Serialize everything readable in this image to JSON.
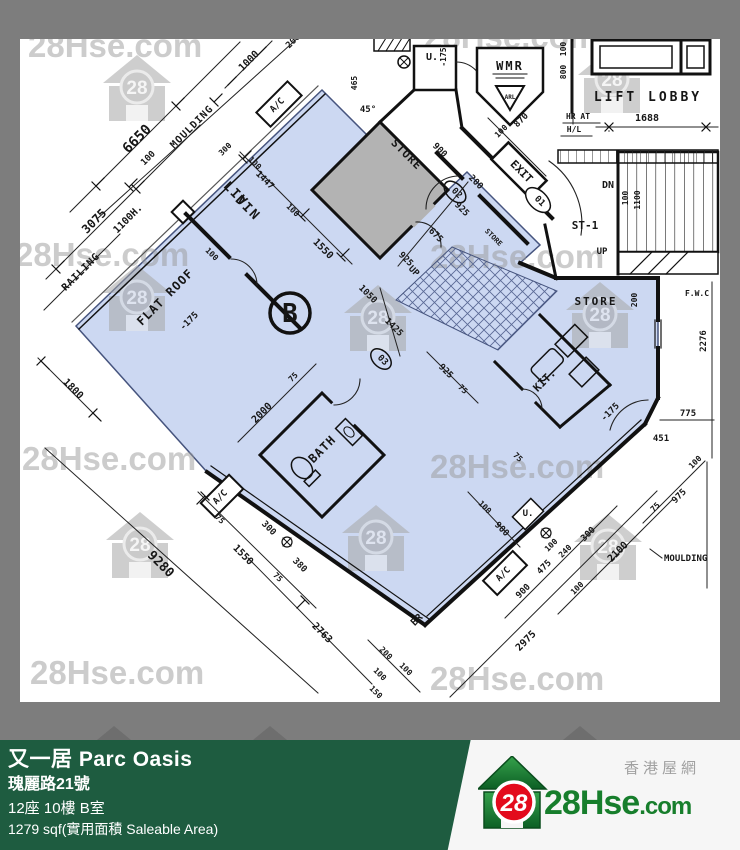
{
  "watermark": {
    "text": "28Hse.com",
    "badge": "28",
    "text_positions": [
      [
        28,
        57
      ],
      [
        424,
        48
      ],
      [
        15,
        266
      ],
      [
        430,
        268
      ],
      [
        22,
        470
      ],
      [
        430,
        478
      ],
      [
        30,
        684
      ],
      [
        430,
        690
      ]
    ],
    "house_positions": [
      [
        102,
        55
      ],
      [
        577,
        47
      ],
      [
        102,
        265
      ],
      [
        343,
        285
      ],
      [
        565,
        282
      ],
      [
        105,
        512
      ],
      [
        341,
        505
      ],
      [
        573,
        514
      ]
    ]
  },
  "floor_plan": {
    "unit_label": "B",
    "highlight_color": "#ccd8f2",
    "labels": [
      {
        "t": "6650",
        "x": 140,
        "y": 142,
        "r": -45,
        "s": 14
      },
      {
        "t": "3075",
        "x": 97,
        "y": 224,
        "r": -45,
        "s": 12
      },
      {
        "t": "100",
        "x": 150,
        "y": 160,
        "r": -45,
        "s": 9
      },
      {
        "t": "MOULDING",
        "x": 194,
        "y": 129,
        "r": -45,
        "s": 10,
        "ls": 1
      },
      {
        "t": "RAILING",
        "x": 83,
        "y": 274,
        "r": -45,
        "s": 10,
        "ls": 1
      },
      {
        "t": "1100H.",
        "x": 130,
        "y": 221,
        "r": -45,
        "s": 10
      },
      {
        "t": "1000",
        "x": 251,
        "y": 63,
        "r": -45,
        "s": 10
      },
      {
        "t": "200",
        "x": 295,
        "y": 43,
        "r": -45,
        "s": 9
      },
      {
        "t": "300",
        "x": 227,
        "y": 151,
        "r": -45,
        "s": 8
      },
      {
        "t": "A/C",
        "x": 279,
        "y": 107,
        "r": -45,
        "s": 9
      },
      {
        "t": "465",
        "x": 357,
        "y": 83,
        "r": -90,
        "s": 8
      },
      {
        "t": "45°",
        "x": 368,
        "y": 112,
        "r": 0,
        "s": 9
      },
      {
        "t": "-175",
        "x": 446,
        "y": 57,
        "r": -90,
        "s": 8
      },
      {
        "t": "U.",
        "x": 432,
        "y": 60,
        "r": 0,
        "s": 10
      },
      {
        "t": "WMR",
        "x": 510,
        "y": 70,
        "r": 0,
        "s": 12,
        "ls": 2
      },
      {
        "t": "ARL",
        "x": 510,
        "y": 99,
        "r": 0,
        "s": 6
      },
      {
        "t": "100",
        "x": 566,
        "y": 49,
        "r": -90,
        "s": 8
      },
      {
        "t": "800",
        "x": 566,
        "y": 72,
        "r": -90,
        "s": 8
      },
      {
        "t": "LIFT LOBBY",
        "x": 648,
        "y": 101,
        "r": 0,
        "s": 13,
        "ls": 3
      },
      {
        "t": "HR AT",
        "x": 578,
        "y": 119,
        "r": 0,
        "s": 8
      },
      {
        "t": "H/L",
        "x": 574,
        "y": 132,
        "r": 0,
        "s": 8
      },
      {
        "t": "1688",
        "x": 647,
        "y": 121,
        "r": 0,
        "s": 10
      },
      {
        "t": "DN",
        "x": 608,
        "y": 188,
        "r": 0,
        "s": 10
      },
      {
        "t": "ST-1",
        "x": 585,
        "y": 229,
        "r": 0,
        "s": 11
      },
      {
        "t": "UP",
        "x": 602,
        "y": 254,
        "r": 0,
        "s": 9
      },
      {
        "t": "100",
        "x": 628,
        "y": 198,
        "r": -90,
        "s": 8
      },
      {
        "t": "1100",
        "x": 640,
        "y": 200,
        "r": -90,
        "s": 8
      },
      {
        "t": "STORE",
        "x": 404,
        "y": 157,
        "r": 45,
        "s": 11,
        "ls": 1
      },
      {
        "t": "900",
        "x": 438,
        "y": 152,
        "r": 45,
        "s": 9
      },
      {
        "t": "100",
        "x": 503,
        "y": 133,
        "r": -45,
        "s": 8
      },
      {
        "t": "870",
        "x": 523,
        "y": 122,
        "r": -45,
        "s": 9
      },
      {
        "t": "EXIT",
        "x": 519,
        "y": 174,
        "r": 45,
        "s": 11
      },
      {
        "t": "01",
        "x": 538,
        "y": 203,
        "r": 45,
        "s": 9
      },
      {
        "t": "02",
        "x": 455,
        "y": 195,
        "r": 45,
        "s": 9
      },
      {
        "t": "200",
        "x": 474,
        "y": 184,
        "r": 45,
        "s": 9
      },
      {
        "t": "925",
        "x": 460,
        "y": 211,
        "r": 45,
        "s": 9
      },
      {
        "t": "675",
        "x": 434,
        "y": 237,
        "r": 45,
        "s": 9
      },
      {
        "t": "STORE",
        "x": 492,
        "y": 239,
        "r": 45,
        "s": 7
      },
      {
        "t": "925",
        "x": 404,
        "y": 261,
        "r": 45,
        "s": 9
      },
      {
        "t": "UP",
        "x": 412,
        "y": 273,
        "r": 45,
        "s": 9
      },
      {
        "t": "1050",
        "x": 366,
        "y": 296,
        "r": 45,
        "s": 9
      },
      {
        "t": "1425",
        "x": 392,
        "y": 329,
        "r": 45,
        "s": 9
      },
      {
        "t": "03",
        "x": 381,
        "y": 362,
        "r": 45,
        "s": 9
      },
      {
        "t": "925",
        "x": 444,
        "y": 373,
        "r": 45,
        "s": 9
      },
      {
        "t": "75",
        "x": 461,
        "y": 391,
        "r": 45,
        "s": 8
      },
      {
        "t": "100",
        "x": 253,
        "y": 165,
        "r": 45,
        "s": 8
      },
      {
        "t": "1447",
        "x": 263,
        "y": 182,
        "r": 45,
        "s": 9
      },
      {
        "t": "100",
        "x": 291,
        "y": 212,
        "r": 45,
        "s": 8
      },
      {
        "t": "1550",
        "x": 321,
        "y": 251,
        "r": 45,
        "s": 10
      },
      {
        "t": "LIV",
        "x": 233,
        "y": 197,
        "r": 45,
        "s": 13,
        "ls": 2
      },
      {
        "t": "DIN",
        "x": 245,
        "y": 211,
        "r": 45,
        "s": 13,
        "ls": 2
      },
      {
        "t": "FLAT ROOF",
        "x": 168,
        "y": 300,
        "r": -45,
        "s": 12,
        "ls": 1
      },
      {
        "t": "100",
        "x": 210,
        "y": 256,
        "r": 45,
        "s": 8
      },
      {
        "t": "-175",
        "x": 191,
        "y": 323,
        "r": -45,
        "s": 9
      },
      {
        "t": "2000",
        "x": 264,
        "y": 415,
        "r": -45,
        "s": 10
      },
      {
        "t": "75",
        "x": 295,
        "y": 379,
        "r": -45,
        "s": 8
      },
      {
        "t": "B",
        "x": 290,
        "y": 322,
        "r": 0,
        "s": 26,
        "b": 1
      },
      {
        "t": "BATH",
        "x": 325,
        "y": 452,
        "r": -45,
        "s": 12,
        "ls": 1
      },
      {
        "t": "1800",
        "x": 71,
        "y": 391,
        "r": 45,
        "s": 10
      },
      {
        "t": "9280",
        "x": 158,
        "y": 567,
        "r": 45,
        "s": 13
      },
      {
        "t": "75",
        "x": 218,
        "y": 521,
        "r": 45,
        "s": 8
      },
      {
        "t": "1550",
        "x": 241,
        "y": 557,
        "r": 45,
        "s": 10
      },
      {
        "t": "300",
        "x": 267,
        "y": 530,
        "r": 45,
        "s": 9
      },
      {
        "t": "380",
        "x": 298,
        "y": 567,
        "r": 45,
        "s": 9
      },
      {
        "t": "75",
        "x": 276,
        "y": 579,
        "r": 45,
        "s": 8
      },
      {
        "t": "2763",
        "x": 320,
        "y": 635,
        "r": 45,
        "s": 10
      },
      {
        "t": "A/C",
        "x": 222,
        "y": 499,
        "r": -45,
        "s": 9
      },
      {
        "t": "A/C",
        "x": 505,
        "y": 576,
        "r": -45,
        "s": 9
      },
      {
        "t": "BR",
        "x": 419,
        "y": 622,
        "r": -45,
        "s": 10
      },
      {
        "t": "U.",
        "x": 528,
        "y": 516,
        "r": 0,
        "s": 9
      },
      {
        "t": "100",
        "x": 483,
        "y": 509,
        "r": 45,
        "s": 8
      },
      {
        "t": "900",
        "x": 500,
        "y": 531,
        "r": 45,
        "s": 9
      },
      {
        "t": "200",
        "x": 384,
        "y": 655,
        "r": 45,
        "s": 8
      },
      {
        "t": "100",
        "x": 404,
        "y": 671,
        "r": 45,
        "s": 8
      },
      {
        "t": "100",
        "x": 378,
        "y": 676,
        "r": 45,
        "s": 8
      },
      {
        "t": "150",
        "x": 374,
        "y": 694,
        "r": 45,
        "s": 8
      },
      {
        "t": "2975",
        "x": 528,
        "y": 643,
        "r": -45,
        "s": 10
      },
      {
        "t": "900",
        "x": 525,
        "y": 593,
        "r": -45,
        "s": 9
      },
      {
        "t": "475",
        "x": 546,
        "y": 569,
        "r": -45,
        "s": 9
      },
      {
        "t": "100",
        "x": 553,
        "y": 547,
        "r": -45,
        "s": 8
      },
      {
        "t": "240",
        "x": 567,
        "y": 553,
        "r": -45,
        "s": 8
      },
      {
        "t": "300",
        "x": 590,
        "y": 536,
        "r": -45,
        "s": 9
      },
      {
        "t": "100",
        "x": 579,
        "y": 590,
        "r": -45,
        "s": 8
      },
      {
        "t": "2100",
        "x": 620,
        "y": 554,
        "r": -45,
        "s": 10
      },
      {
        "t": "75",
        "x": 657,
        "y": 509,
        "r": -45,
        "s": 8
      },
      {
        "t": "975",
        "x": 681,
        "y": 498,
        "r": -45,
        "s": 9
      },
      {
        "t": "100",
        "x": 697,
        "y": 464,
        "r": -45,
        "s": 8
      },
      {
        "t": "MOULDING",
        "x": 664,
        "y": 561,
        "r": 0,
        "s": 9,
        "a": "s"
      },
      {
        "t": "775",
        "x": 688,
        "y": 416,
        "r": 0,
        "s": 9
      },
      {
        "t": "451",
        "x": 661,
        "y": 441,
        "r": 0,
        "s": 9
      },
      {
        "t": "F.W.C",
        "x": 697,
        "y": 296,
        "r": 0,
        "s": 8
      },
      {
        "t": "2276",
        "x": 706,
        "y": 341,
        "r": -90,
        "s": 9
      },
      {
        "t": "200",
        "x": 637,
        "y": 300,
        "r": -90,
        "s": 8
      },
      {
        "t": "STORE",
        "x": 596,
        "y": 305,
        "r": 0,
        "s": 11,
        "ls": 2
      },
      {
        "t": "-175",
        "x": 612,
        "y": 414,
        "r": -45,
        "s": 9
      },
      {
        "t": "KIT.",
        "x": 547,
        "y": 383,
        "r": -45,
        "s": 11
      },
      {
        "t": "75",
        "x": 516,
        "y": 459,
        "r": 45,
        "s": 8
      }
    ]
  },
  "info_bar": {
    "building_name": "又一居 Parc Oasis",
    "address": "瑰麗路21號",
    "unit": "12座 10樓 B室",
    "area": "1279 sqf(實用面積 Saleable Area)",
    "site_name_cn": "香港屋網",
    "site_logo_main": "28Hse",
    "site_logo_suffix": ".com",
    "logo_badge": "28",
    "colors": {
      "bar_green": "#1e5c40",
      "logo_green": "#177e2c",
      "badge_red": "#e30b1c"
    }
  }
}
